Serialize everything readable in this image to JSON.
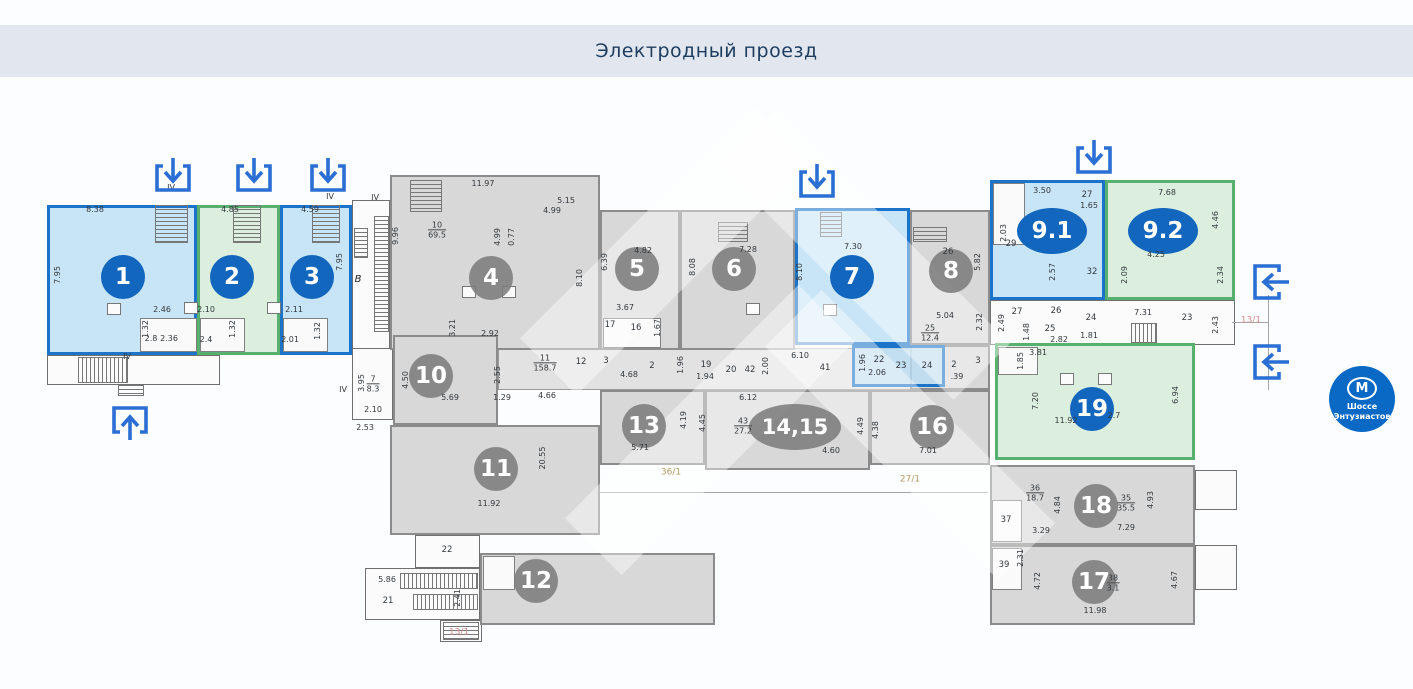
{
  "header": {
    "title": "Электродный проезд"
  },
  "metro": {
    "letter": "М",
    "line1": "Шоссе",
    "line2": "Энтузиастов"
  },
  "colors": {
    "bar": "#e2e7ef",
    "title": "#1d3c5e",
    "unit_blue_border": "#1b74c9",
    "unit_blue_fill": "#badff5",
    "unit_green_border": "#57b06d",
    "unit_green_fill": "#d6ecd8",
    "unit_gray_fill": "#d8d8d8",
    "badge_blue": "#1266be",
    "badge_gray": "#7c7c7c",
    "arrow_blue": "#2b6fd4",
    "metro_blue": "#0a69c5",
    "red_label": "#d98b8b",
    "tan_label": "#b3995f"
  },
  "plan": {
    "units": [
      [
        "",
        "outline",
        47,
        355,
        173,
        30
      ],
      [
        "",
        "outline",
        352,
        200,
        38,
        155
      ],
      [
        "",
        "outline",
        352,
        348,
        41,
        72
      ],
      [
        "",
        "corr",
        498,
        348,
        492,
        42
      ],
      [
        "",
        "outline",
        990,
        300,
        245,
        45
      ],
      [
        "22к",
        "outline",
        415,
        535,
        65,
        33
      ],
      [
        "21к",
        "outline",
        365,
        568,
        115,
        52
      ],
      [
        "",
        "outline",
        440,
        620,
        42,
        22
      ],
      [
        "",
        "outline",
        1195,
        470,
        42,
        40
      ],
      [
        "",
        "outline",
        1195,
        545,
        42,
        45
      ],
      [
        "4",
        "gray",
        390,
        175,
        210,
        175
      ],
      [
        "5",
        "gray",
        600,
        210,
        80,
        140
      ],
      [
        "6",
        "gray",
        680,
        210,
        115,
        140
      ],
      [
        "8",
        "gray",
        910,
        210,
        80,
        135
      ],
      [
        "",
        "gray",
        910,
        345,
        80,
        45
      ],
      [
        "10",
        "gray",
        393,
        335,
        105,
        90
      ],
      [
        "11",
        "gray",
        390,
        425,
        210,
        110
      ],
      [
        "12",
        "gray",
        480,
        553,
        235,
        72
      ],
      [
        "13",
        "gray",
        600,
        390,
        105,
        75
      ],
      [
        "14,15",
        "gray",
        705,
        390,
        165,
        80
      ],
      [
        "16",
        "gray",
        870,
        390,
        120,
        75
      ],
      [
        "18",
        "gray",
        990,
        465,
        205,
        80
      ],
      [
        "17",
        "gray",
        990,
        545,
        205,
        80
      ],
      [
        "1",
        "blue",
        47,
        205,
        150,
        150
      ],
      [
        "2",
        "green",
        197,
        205,
        83,
        150
      ],
      [
        "3",
        "blue",
        280,
        205,
        72,
        150
      ],
      [
        "7",
        "blue",
        795,
        208,
        115,
        137
      ],
      [
        "",
        "blue",
        852,
        345,
        93,
        42
      ],
      [
        "9.1",
        "blue",
        990,
        180,
        115,
        120
      ],
      [
        "9.2",
        "green",
        1105,
        180,
        130,
        120
      ],
      [
        "19",
        "green",
        995,
        343,
        200,
        117
      ]
    ],
    "badges": [
      [
        "1",
        123,
        277,
        "blue"
      ],
      [
        "2",
        232,
        277,
        "blue"
      ],
      [
        "3",
        312,
        277,
        "blue"
      ],
      [
        "4",
        491,
        278,
        "gray"
      ],
      [
        "5",
        637,
        269,
        "gray"
      ],
      [
        "6",
        734,
        269,
        "gray"
      ],
      [
        "7",
        852,
        277,
        "blue"
      ],
      [
        "8",
        951,
        271,
        "gray"
      ],
      [
        "9.1",
        1052,
        231,
        "blue",
        70,
        46
      ],
      [
        "9.2",
        1163,
        231,
        "blue",
        70,
        46
      ],
      [
        "10",
        431,
        376,
        "gray"
      ],
      [
        "11",
        496,
        469,
        "gray"
      ],
      [
        "12",
        536,
        581,
        "gray"
      ],
      [
        "13",
        644,
        426,
        "gray"
      ],
      [
        "14,15",
        795,
        427,
        "gray",
        92,
        46
      ],
      [
        "16",
        932,
        427,
        "gray"
      ],
      [
        "17",
        1094,
        582,
        "gray"
      ],
      [
        "18",
        1096,
        506,
        "gray"
      ],
      [
        "19",
        1092,
        409,
        "blue"
      ]
    ],
    "labels": [
      [
        "8.38",
        95,
        210
      ],
      [
        "7.95",
        58,
        275,
        1
      ],
      [
        "2.46",
        162,
        310
      ],
      [
        "1.32",
        146,
        329,
        1
      ],
      [
        "2.8",
        151,
        339
      ],
      [
        "2.36",
        169,
        339
      ],
      [
        "4.85",
        230,
        210
      ],
      [
        "2.10",
        206,
        310
      ],
      [
        "2.4",
        206,
        340
      ],
      [
        "1.32",
        233,
        329,
        1
      ],
      [
        "4.59",
        310,
        210
      ],
      [
        "7.95",
        340,
        262,
        1
      ],
      [
        "2.11",
        294,
        310
      ],
      [
        "2.01",
        290,
        340
      ],
      [
        "1.32",
        318,
        331,
        1
      ],
      [
        "IV",
        171,
        188
      ],
      [
        "IV",
        330,
        197
      ],
      [
        "IV",
        375,
        198
      ],
      [
        "IV",
        127,
        357
      ],
      [
        "IV",
        343,
        390
      ],
      [
        "В",
        358,
        280,
        "letter"
      ],
      [
        "11.97",
        483,
        184
      ],
      [
        "9.96",
        396,
        236,
        1
      ],
      [
        "5.15",
        566,
        201
      ],
      [
        "4.99",
        552,
        211
      ],
      [
        "4.99",
        498,
        237,
        1
      ],
      [
        "0.77",
        512,
        237,
        1
      ],
      [
        "8.10",
        580,
        278,
        1
      ],
      [
        "3.21",
        453,
        328,
        1
      ],
      [
        "2.92",
        490,
        334
      ],
      [
        "6.39",
        605,
        262,
        1
      ],
      [
        "4.82",
        643,
        251
      ],
      [
        "3.67",
        625,
        308
      ],
      [
        "17",
        610,
        325,
        "room"
      ],
      [
        "16",
        636,
        328,
        "room"
      ],
      [
        "1.67",
        658,
        328,
        1
      ],
      [
        "8.08",
        693,
        267,
        1
      ],
      [
        "7.28",
        748,
        250
      ],
      [
        "8.10",
        800,
        272,
        1
      ],
      [
        "7.30",
        853,
        247
      ],
      [
        "1.96",
        863,
        363,
        1
      ],
      [
        "22",
        879,
        360,
        "room"
      ],
      [
        "2.06",
        877,
        373
      ],
      [
        "23",
        901,
        366,
        "room"
      ],
      [
        "26",
        948,
        252,
        "room"
      ],
      [
        "5.82",
        978,
        262,
        1
      ],
      [
        "5.04",
        945,
        316
      ],
      [
        "2.32",
        980,
        322,
        1
      ],
      [
        "24",
        927,
        366,
        "room"
      ],
      [
        "2",
        954,
        365,
        "room"
      ],
      [
        "3",
        978,
        361,
        "room"
      ],
      [
        ".39",
        957,
        377
      ],
      [
        "3.50",
        1042,
        191
      ],
      [
        "27",
        1087,
        195,
        "room"
      ],
      [
        "1.65",
        1089,
        206
      ],
      [
        "2.03",
        1004,
        233,
        1
      ],
      [
        "29",
        1011,
        244,
        "room"
      ],
      [
        "2.57",
        1053,
        272,
        1
      ],
      [
        "32",
        1092,
        272,
        "room"
      ],
      [
        "7.68",
        1167,
        193
      ],
      [
        "4.46",
        1216,
        220,
        1
      ],
      [
        "4.25",
        1156,
        255
      ],
      [
        "2.09",
        1125,
        275,
        1
      ],
      [
        "2.34",
        1221,
        275,
        1
      ],
      [
        "2.49",
        1002,
        323,
        1
      ],
      [
        "27",
        1017,
        312,
        "room"
      ],
      [
        "26",
        1056,
        311,
        "room"
      ],
      [
        "25",
        1050,
        329,
        "room"
      ],
      [
        "1.48",
        1027,
        332,
        1
      ],
      [
        "2.82",
        1059,
        340
      ],
      [
        "24",
        1091,
        318,
        "room"
      ],
      [
        "1.81",
        1089,
        336
      ],
      [
        "7.31",
        1143,
        313
      ],
      [
        "23",
        1187,
        318,
        "room"
      ],
      [
        "2.43",
        1216,
        325,
        1
      ],
      [
        "13/1",
        1251,
        321,
        "red"
      ],
      [
        "13/1",
        459,
        633,
        "red"
      ],
      [
        "3.81",
        1038,
        353
      ],
      [
        "1.85",
        1021,
        361,
        1
      ],
      [
        "7.20",
        1036,
        401,
        1
      ],
      [
        "11.92",
        1066,
        421
      ],
      [
        "2.7",
        1114,
        416
      ],
      [
        "6.94",
        1176,
        395,
        1
      ],
      [
        "4.50",
        406,
        380,
        1
      ],
      [
        "3.95",
        362,
        383,
        1
      ],
      [
        "2.10",
        373,
        410
      ],
      [
        "2.53",
        365,
        428
      ],
      [
        "5.69",
        450,
        398
      ],
      [
        "2.55",
        498,
        375,
        1
      ],
      [
        "1.29",
        502,
        398
      ],
      [
        "12",
        581,
        362,
        "room"
      ],
      [
        "3",
        606,
        361,
        "room"
      ],
      [
        "4.66",
        547,
        396
      ],
      [
        "2",
        652,
        366,
        "room"
      ],
      [
        "4.68",
        629,
        375
      ],
      [
        "1.96",
        681,
        365,
        1
      ],
      [
        "19",
        706,
        365,
        "room"
      ],
      [
        "1.94",
        705,
        377
      ],
      [
        "20",
        731,
        370,
        "room"
      ],
      [
        "42",
        750,
        370,
        "room"
      ],
      [
        "2.00",
        766,
        366,
        1
      ],
      [
        "6.10",
        800,
        356
      ],
      [
        "41",
        825,
        368,
        "room"
      ],
      [
        "20.55",
        543,
        458,
        1
      ],
      [
        "11.92",
        489,
        504
      ],
      [
        "22",
        447,
        550,
        "room"
      ],
      [
        "5.86",
        387,
        580
      ],
      [
        "21",
        388,
        601,
        "room"
      ],
      [
        "2.41",
        458,
        598,
        1
      ],
      [
        "5.71",
        640,
        448
      ],
      [
        "4.19",
        684,
        420,
        1
      ],
      [
        "6.12",
        748,
        398
      ],
      [
        "4.45",
        703,
        423,
        1
      ],
      [
        "4.60",
        831,
        451
      ],
      [
        "4.49",
        861,
        426,
        1
      ],
      [
        "4.38",
        876,
        430,
        1
      ],
      [
        "7.01",
        928,
        451
      ],
      [
        "36/1",
        671,
        473,
        "tan"
      ],
      [
        "27/1",
        910,
        480,
        "tan"
      ],
      [
        "4.84",
        1058,
        505,
        1
      ],
      [
        "3.29",
        1041,
        531
      ],
      [
        "7.29",
        1126,
        528
      ],
      [
        "4.93",
        1151,
        500,
        1
      ],
      [
        "37",
        1006,
        520,
        "room"
      ],
      [
        "39",
        1004,
        565,
        "room"
      ],
      [
        "2.31",
        1021,
        558,
        1
      ],
      [
        "4.72",
        1038,
        581,
        1
      ],
      [
        "11.98",
        1095,
        611
      ],
      [
        "4.67",
        1175,
        580,
        1
      ]
    ],
    "fracs": [
      [
        "10",
        "69.5",
        437,
        230
      ],
      [
        "11",
        "158.7",
        545,
        363
      ],
      [
        "25",
        "12.4",
        930,
        333
      ],
      [
        "43",
        "27.2",
        743,
        426
      ],
      [
        "36",
        "18.7",
        1035,
        493
      ],
      [
        "35",
        "35.5",
        1126,
        503
      ],
      [
        "38",
        "3.1",
        1113,
        583
      ],
      [
        "7",
        "8.3",
        373,
        384
      ]
    ],
    "stairs": [
      [
        155,
        205,
        33,
        38,
        "h"
      ],
      [
        233,
        205,
        28,
        38,
        "h"
      ],
      [
        312,
        205,
        28,
        38,
        "h"
      ],
      [
        374,
        216,
        15,
        116,
        "h"
      ],
      [
        354,
        228,
        14,
        30,
        "h"
      ],
      [
        78,
        357,
        50,
        26,
        "v"
      ],
      [
        118,
        385,
        26,
        11,
        "h"
      ],
      [
        410,
        180,
        32,
        32,
        "h"
      ],
      [
        718,
        222,
        30,
        20,
        "h"
      ],
      [
        820,
        212,
        22,
        25,
        "h"
      ],
      [
        913,
        227,
        34,
        15,
        "h"
      ],
      [
        1131,
        323,
        26,
        20,
        "v"
      ],
      [
        400,
        573,
        78,
        16,
        "v"
      ],
      [
        413,
        594,
        65,
        16,
        "v"
      ],
      [
        443,
        622,
        36,
        18,
        "h"
      ]
    ],
    "white_rooms": [
      [
        140,
        318,
        57,
        34
      ],
      [
        200,
        318,
        45,
        34
      ],
      [
        283,
        318,
        45,
        34
      ],
      [
        603,
        318,
        58,
        30
      ],
      [
        993,
        183,
        32,
        62
      ],
      [
        998,
        347,
        40,
        28
      ],
      [
        992,
        500,
        30,
        42
      ],
      [
        992,
        548,
        30,
        42
      ],
      [
        483,
        556,
        32,
        34
      ]
    ],
    "squares": [
      [
        462,
        286
      ],
      [
        502,
        286
      ],
      [
        746,
        303
      ],
      [
        823,
        304
      ],
      [
        107,
        303
      ],
      [
        184,
        302
      ],
      [
        267,
        302
      ],
      [
        1060,
        373
      ],
      [
        1098,
        373
      ]
    ],
    "lines": [
      [
        600,
        492,
        388,
        1
      ],
      [
        1268,
        295,
        1,
        95
      ],
      [
        1232,
        322,
        36,
        1
      ]
    ],
    "arrows": [
      [
        "down",
        152,
        157
      ],
      [
        "down",
        233,
        157
      ],
      [
        "down",
        307,
        157
      ],
      [
        "down",
        796,
        163
      ],
      [
        "down",
        1073,
        139
      ],
      [
        "up",
        109,
        397
      ],
      [
        "left",
        1246,
        261
      ],
      [
        "left",
        1246,
        341
      ]
    ]
  }
}
